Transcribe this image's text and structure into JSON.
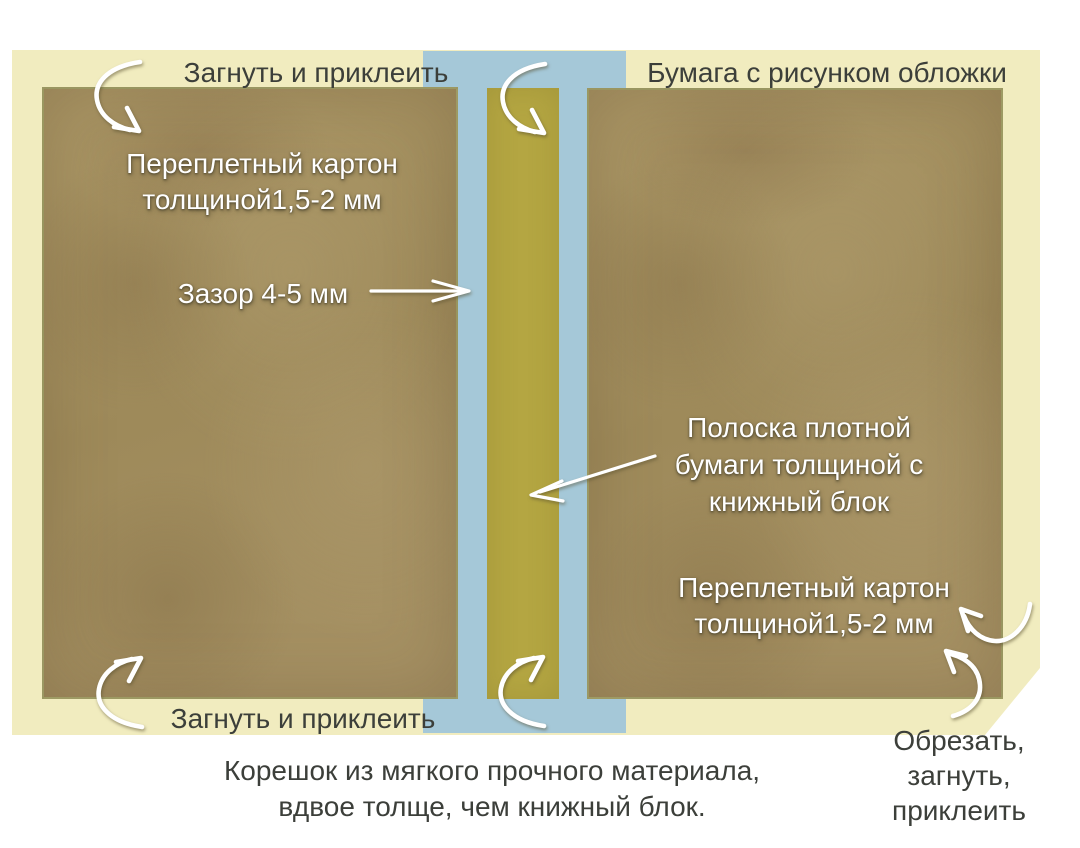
{
  "colors": {
    "background": "#ffffff",
    "paper": "#f1ecbf",
    "spine_band": "#a5c8d8",
    "spine_strip": "#b4a642",
    "board": "#a59060",
    "text_dark": "#3c3f3a",
    "text_light": "#ffffff",
    "arrow": "#ffffff"
  },
  "labels": {
    "fold_glue_top": "Загнуть и приклеить",
    "cover_paper": "Бумага с рисунком обложки",
    "left_board": {
      "lines": [
        "Переплетный картон",
        "толщиной1,5-2 мм"
      ]
    },
    "gap": "Зазор 4-5 мм",
    "spine_strip": {
      "lines": [
        "Полоска плотной",
        "бумаги толщиной с",
        "книжный блок"
      ]
    },
    "right_board": {
      "lines": [
        "Переплетный картон",
        "толщиной1,5-2 мм"
      ]
    },
    "fold_glue_bottom": "Загнуть и приклеить",
    "trim_fold_glue": {
      "lines": [
        "Обрезать,",
        "загнуть,",
        "приклеить"
      ]
    },
    "spine_note": {
      "lines": [
        "Корешок из мягкого прочного материала,",
        "вдвое толще, чем книжный блок."
      ]
    }
  }
}
